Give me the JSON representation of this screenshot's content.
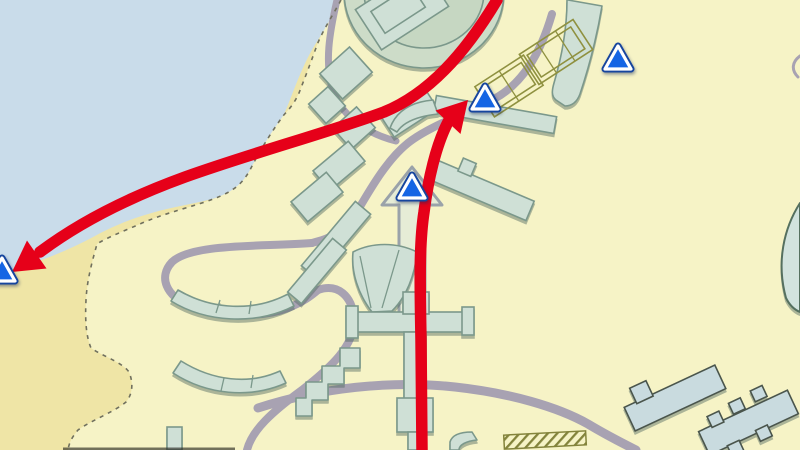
{
  "map": {
    "width": 800,
    "height": 450,
    "colors": {
      "water": "#c9dcea",
      "sand": "#efe5a6",
      "land": "#f6f3c6",
      "boundary": "#70705e",
      "road": "#a8a2b2",
      "building": "#cfe0d6",
      "buildingStroke": "#7b988b",
      "court": "#8f9140",
      "hatch": "#83833b",
      "route": "#e60019",
      "promenadeFill": "#e6ecd6",
      "promenadeStroke": "#9aa2a9",
      "markerFill": "#1565e4",
      "markerEdge": "#16459e",
      "markerBorder": "#ffffff",
      "frameEdge": "#2a2a22"
    },
    "regions": {
      "sand": "M0,272 C35,264 65,252 95,236 C130,217 160,210 190,204 C220,198 240,192 252,176 C264,158 275,134 285,112 C293,94 302,64 318,40 C327,26 336,12 340,0 L800,0 L800,450 L0,450 Z",
      "land": "M341,0 C333,15 323,30 317,45 C310,65 304,80 299,93 C293,106 288,110 283,116 C270,134 259,152 250,170 C240,188 228,194 205,202 C180,210 160,215 140,224 C124,231 106,238 97,244 C92,262 87,280 86,300 C85,320 86,336 91,348 C102,356 122,362 129,372 C134,384 132,395 126,402 C114,412 92,420 78,430 C72,437 69,443 68,450 L800,450 L800,0 Z",
      "boundary": "M341,0 C333,15 323,30 317,45 C310,65 304,80 299,93 C293,106 288,110 283,116 C270,134 259,152 250,170 C240,188 228,194 205,202 C180,210 160,215 140,224 C124,231 106,238 97,244 C92,262 87,280 86,300 C85,320 86,336 91,348 C102,356 122,362 129,372 C134,384 132,395 126,402 C114,412 92,420 78,430 C72,437 69,443 68,450"
    },
    "roads": [
      {
        "name": "coast-road",
        "d": "M337,0 C329,35 325,62 332,88 C340,114 364,133 396,141",
        "width": 7
      },
      {
        "name": "court-road",
        "d": "M552,14 C540,55 522,84 494,99 C466,113 428,127 408,143 C388,159 372,186 358,210 C340,238 322,240 312,243",
        "width": 8
      },
      {
        "name": "loop-road",
        "d": "M312,243 C262,247 192,243 172,262 C158,277 166,296 190,306 C220,317 262,318 288,308 C303,302 311,296 318,290",
        "width": 8
      },
      {
        "name": "loop-descent-road",
        "d": "M318,290 C338,283 352,296 354,318 C356,345 330,368 302,390 C272,412 252,430 247,450",
        "width": 8
      },
      {
        "name": "south-road",
        "d": "M258,408 C320,388 390,380 455,387 C510,393 558,407 588,424 C603,433 620,442 636,450",
        "width": 9
      },
      {
        "name": "right-edge-stub-road",
        "d": "M800,56 C792,62 791,70 798,77",
        "width": 3
      }
    ],
    "promenade": {
      "name": "promenade-arrow",
      "d": "M412,167 L382,205 L399,205 L399,316 L425,316 L425,205 L442,205 Z"
    },
    "buildings": [
      {
        "name": "stadium-bowl",
        "ellipses": [
          [
            424,
            -8,
            80,
            76
          ]
        ],
        "fill": "#cddcc8"
      },
      {
        "name": "stadium-ring",
        "ellipses": [
          [
            424,
            -8,
            60,
            56
          ]
        ],
        "fill": "#c6d7c2"
      },
      {
        "name": "stadium-hall",
        "rotate": "-33 402 8",
        "rects": [
          [
            362,
            -16,
            80,
            48
          ]
        ]
      },
      {
        "name": "stadium-hall-inner",
        "rotate": "-33 402 8",
        "rects": [
          [
            374,
            -6,
            48,
            26
          ]
        ],
        "fillNone": true
      },
      {
        "name": "diamond-block-1",
        "rotate": "-42 346 73",
        "rects": [
          [
            326,
            56,
            40,
            34
          ]
        ]
      },
      {
        "name": "diamond-block-2",
        "rotate": "-42 327 105",
        "rects": [
          [
            314,
            92,
            26,
            26
          ]
        ]
      },
      {
        "name": "diamond-block-3",
        "rotate": "-42 354 128",
        "rects": [
          [
            338,
            114,
            32,
            28
          ]
        ]
      },
      {
        "name": "terrace-block-1",
        "rotate": "-33 409 112",
        "rects": [
          [
            383,
            99,
            52,
            26
          ]
        ]
      },
      {
        "name": "terrace-block-2",
        "rotate": "-40 339 166",
        "rects": [
          [
            316,
            153,
            46,
            26
          ]
        ]
      },
      {
        "name": "terrace-block-3",
        "rotate": "-40 317 197",
        "rects": [
          [
            294,
            184,
            46,
            26
          ]
        ]
      },
      {
        "name": "slab-block-1",
        "rotate": "-50 336 240",
        "rects": [
          [
            294,
            230,
            84,
            20
          ]
        ]
      },
      {
        "name": "slab-block-2",
        "rotate": "-50 317 271",
        "rects": [
          [
            282,
            262,
            70,
            18
          ]
        ]
      },
      {
        "name": "curved-tower",
        "d": "M568,0 L602,6 C597,36 590,64 580,94 C577,102 572,106 565,106 L556,100 C551,96 552,90 554,83 C562,56 567,28 567,0 Z"
      },
      {
        "name": "ridge-bar-upper",
        "rotate": "10 495 115",
        "rects": [
          [
            434,
            106,
            122,
            17
          ]
        ]
      },
      {
        "name": "ridge-bar-lower",
        "rotate": "23 482 191",
        "rects": [
          [
            430,
            180,
            104,
            21
          ],
          [
            452,
            168,
            14,
            14
          ]
        ]
      },
      {
        "name": "wing-pavilion",
        "d": "M390,128 C396,112 410,102 433,100 L438,114 C420,116 404,121 397,132 Z"
      },
      {
        "name": "fan-pavilion",
        "d": "M372,312 C358,294 351,272 353,252 C372,242 397,242 417,252 C415,276 406,297 392,311 Z",
        "lines": [
          [
            371,
            308,
            360,
            256
          ],
          [
            382,
            308,
            399,
            250
          ]
        ]
      },
      {
        "name": "plaza-complex",
        "rects": [
          [
            354,
            312,
            112,
            20
          ],
          [
            346,
            306,
            12,
            32
          ],
          [
            462,
            307,
            12,
            28
          ],
          [
            403,
            292,
            26,
            22
          ],
          [
            404,
            332,
            22,
            68
          ],
          [
            397,
            398,
            36,
            34
          ],
          [
            408,
            432,
            18,
            18
          ]
        ]
      },
      {
        "name": "zigzag-hall",
        "d": "M360,348 L360,368 L344,368 L344,384 L328,384 L328,400 L312,400 L312,416 L296,416 L296,398 L306,398 L306,382 L322,382 L322,366 L340,366 L340,348 Z"
      },
      {
        "name": "arc-hall-north",
        "d": "M178,290 C212,310 254,312 288,294 L294,306 C255,326 205,322 171,301 Z",
        "lines": [
          [
            216,
            313,
            220,
            300
          ],
          [
            249,
            314,
            251,
            301
          ]
        ]
      },
      {
        "name": "arc-hall-south",
        "d": "M181,361 C213,381 249,385 280,371 L286,383 C250,399 207,395 173,373 Z",
        "lines": [
          [
            221,
            391,
            224,
            378
          ],
          [
            251,
            388,
            253,
            375
          ]
        ]
      },
      {
        "name": "small-house",
        "rects": [
          [
            167,
            427,
            15,
            23
          ]
        ]
      },
      {
        "name": "se-slab",
        "rotate": "-25 675 398",
        "rects": [
          [
            625,
            385,
            100,
            26
          ],
          [
            638,
            370,
            18,
            17
          ]
        ],
        "stroke": "#4a554c",
        "fill": "#c9dbdf"
      },
      {
        "name": "se-terrace",
        "rotate": "-25 748 424",
        "rects": [
          [
            700,
            410,
            98,
            26
          ],
          [
            714,
            400,
            13,
            12
          ],
          [
            739,
            397,
            13,
            12
          ],
          [
            764,
            395,
            13,
            12
          ],
          [
            720,
            435,
            13,
            12
          ],
          [
            752,
            433,
            13,
            12
          ]
        ],
        "stroke": "#4a554c",
        "fill": "#c9dbdf"
      },
      {
        "name": "right-edge-arena",
        "d": "M800,203 C784,228 776,262 786,298 C790,306 795,310 800,312 Z",
        "fill": "#d2e3de",
        "stroke": "#55705f",
        "strokeWidth": 2
      },
      {
        "name": "kiosk-curved",
        "d": "M450,450 L450,442 C452,435 460,432 472,432 L477,440 C466,441 459,445 459,450 Z"
      }
    ],
    "courts": [
      {
        "name": "tennis-courts-south",
        "rotate": "-33 509 86",
        "rects": [
          [
            480,
            68,
            58,
            36
          ],
          [
            486,
            73,
            46,
            26
          ]
        ],
        "lines": [
          [
            509,
            68,
            509,
            104
          ]
        ]
      },
      {
        "name": "tennis-courts-north",
        "rotate": "-33 556 52",
        "rects": [
          [
            524,
            34,
            64,
            36
          ],
          [
            530,
            39,
            52,
            26
          ]
        ],
        "lines": [
          [
            545,
            34,
            545,
            70
          ],
          [
            567,
            34,
            567,
            70
          ]
        ]
      }
    ],
    "hatchArea": {
      "name": "hatched-zone",
      "rotate": "-3 545 440",
      "x": 504,
      "y": 433,
      "w": 82,
      "h": 14
    },
    "routes": [
      {
        "name": "route-west",
        "d": "M497,0 C464,55 428,94 384,112 C330,132 255,152 185,177 C130,197 80,222 40,252",
        "width": 11.5,
        "head": "12,272 27,240.5 46.5,268.5"
      },
      {
        "name": "route-north",
        "d": "M422,450 L421,340 C420,285 419,245 424,212 C428,180 436,145 448,122",
        "width": 11.5,
        "head": "468,100 435.5,110.5 460.5,134"
      }
    ],
    "markers": [
      {
        "name": "marker-west-terminal",
        "cx": 2,
        "cy": 270
      },
      {
        "name": "marker-promenade",
        "cx": 412,
        "cy": 187
      },
      {
        "name": "marker-courts",
        "cx": 485,
        "cy": 98
      },
      {
        "name": "marker-northeast",
        "cx": 618,
        "cy": 58
      }
    ],
    "frameArtifact": {
      "x": 63,
      "y": 447.5,
      "w": 172,
      "h": 2.5
    }
  }
}
